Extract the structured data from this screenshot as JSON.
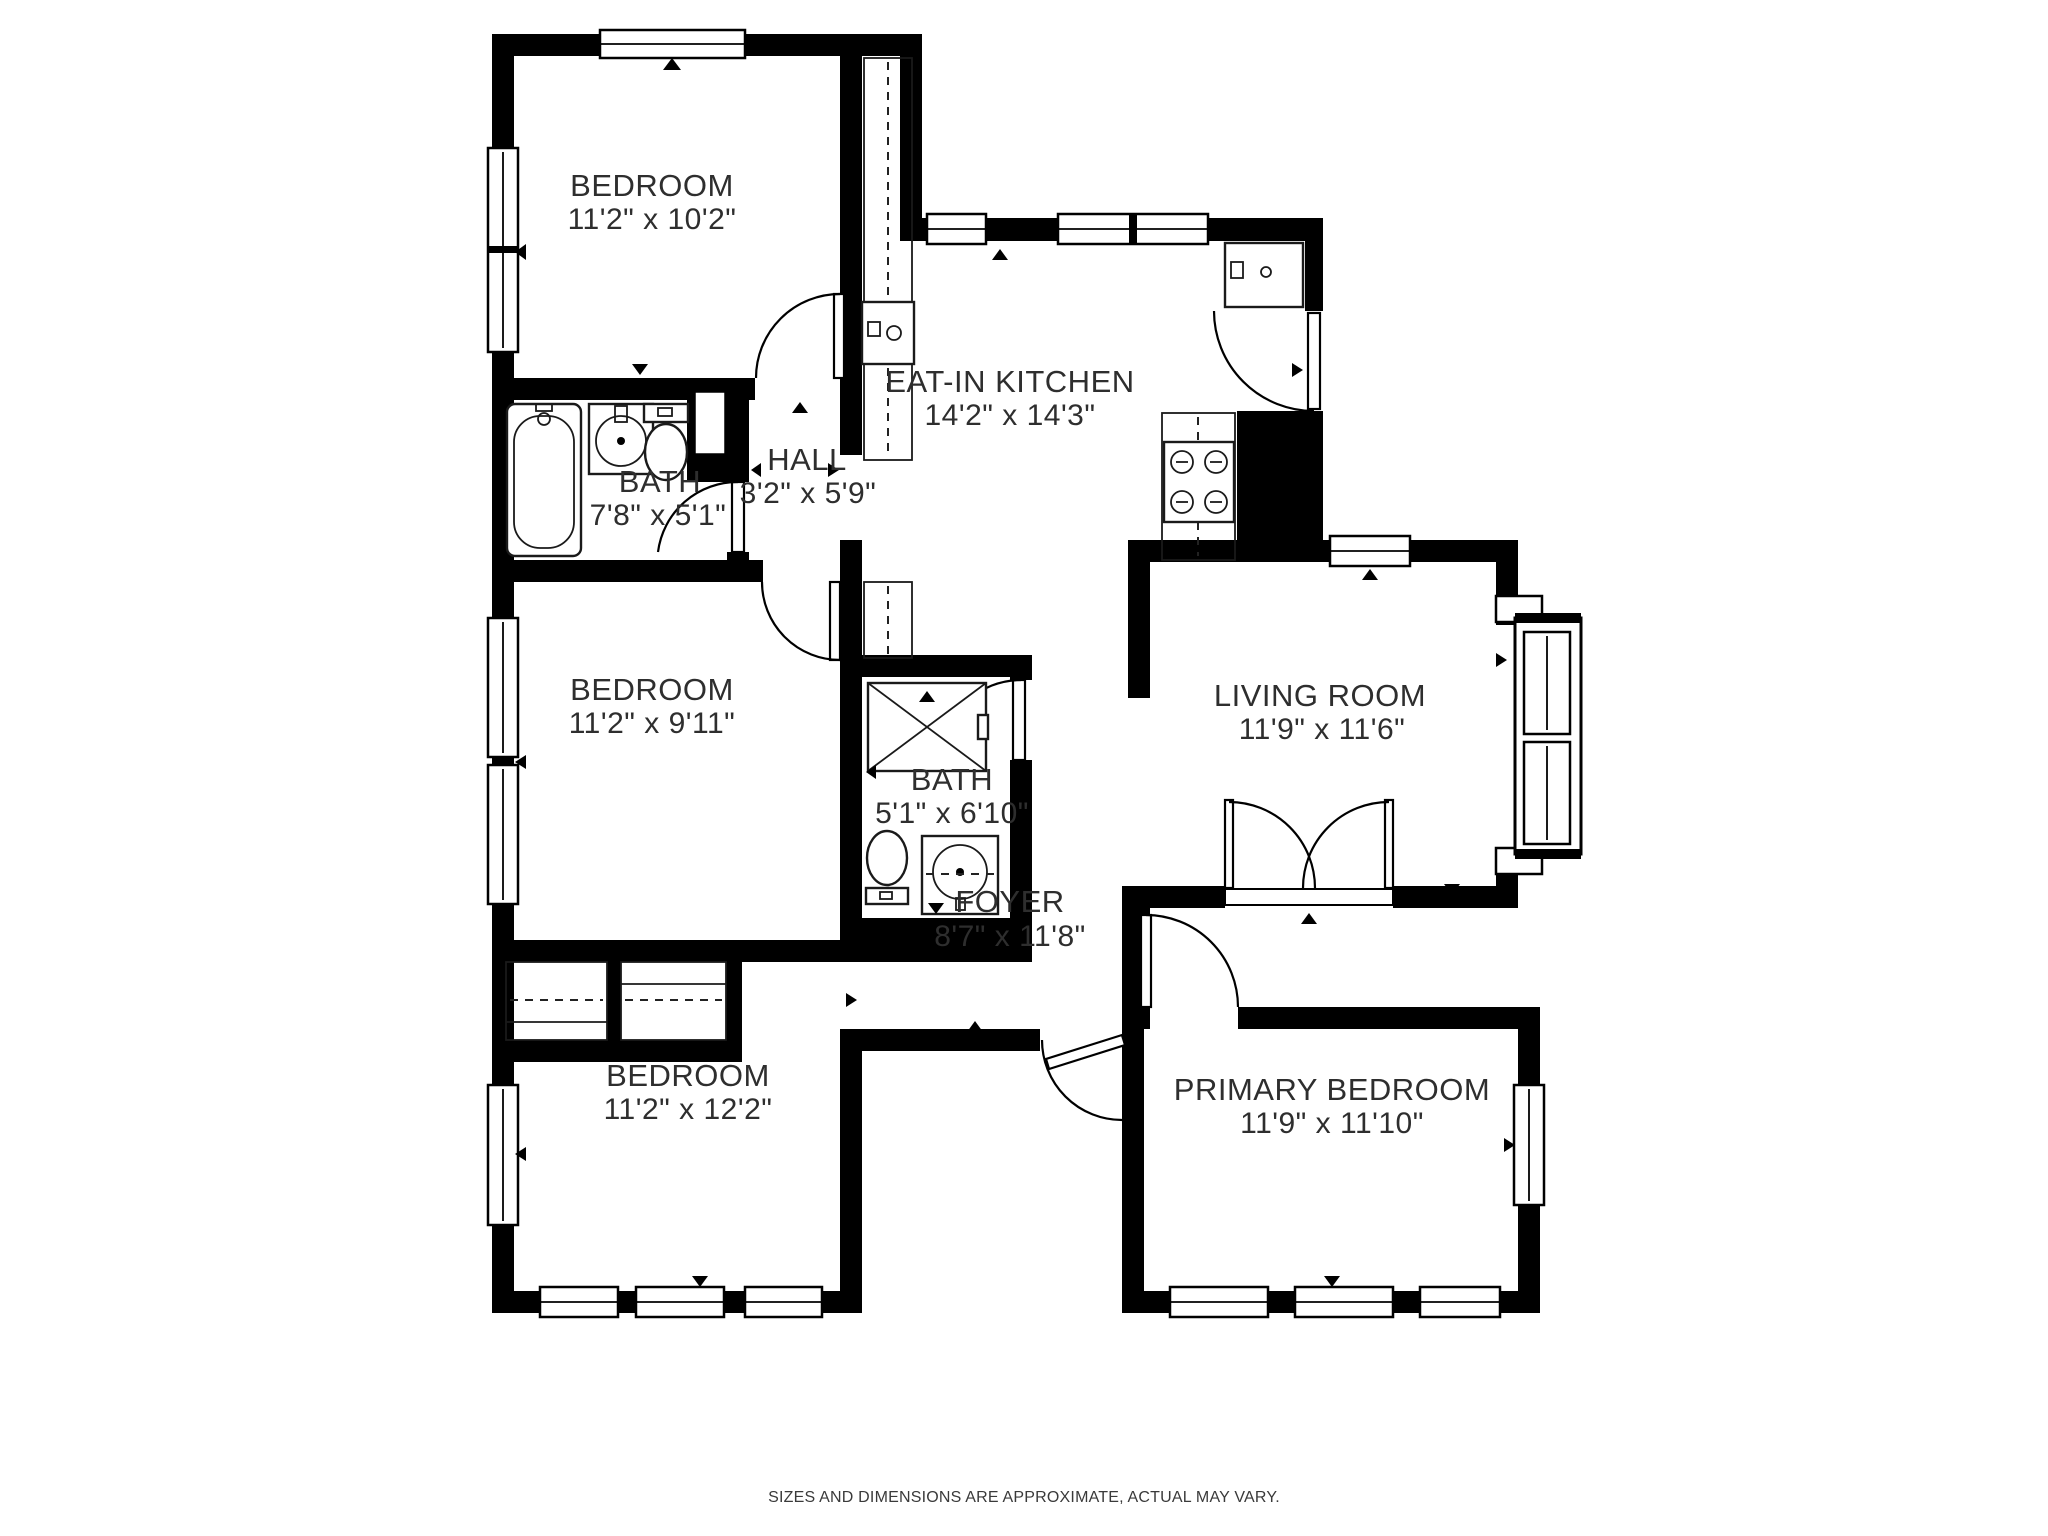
{
  "plan": {
    "title": "floor-plan",
    "rooms": [
      {
        "id": "bedroom-top-left",
        "name": "BEDROOM",
        "dims": "11'2\" x 10'2\""
      },
      {
        "id": "eat-in-kitchen",
        "name": "EAT-IN KITCHEN",
        "dims": "14'2\" x 14'3\""
      },
      {
        "id": "bath-top",
        "name": "BATH",
        "dims": "7'8\" x 5'1\""
      },
      {
        "id": "hall",
        "name": "HALL",
        "dims": "3'2\" x 5'9\""
      },
      {
        "id": "bedroom-middle",
        "name": "BEDROOM",
        "dims": "11'2\" x 9'11\""
      },
      {
        "id": "bath-middle",
        "name": "BATH",
        "dims": "5'1\" x 6'10\""
      },
      {
        "id": "living-room",
        "name": "LIVING ROOM",
        "dims": "11'9\" x 11'6\""
      },
      {
        "id": "foyer",
        "name": "FOYER",
        "dims": "8'7\" x 11'8\""
      },
      {
        "id": "bedroom-bottom-left",
        "name": "BEDROOM",
        "dims": "11'2\" x 12'2\""
      },
      {
        "id": "primary-bedroom",
        "name": "PRIMARY BEDROOM",
        "dims": "11'9\" x 11'10\""
      }
    ],
    "fixtures": [
      "bathtub",
      "vanity-sink",
      "toilet",
      "shower",
      "kitchen-sink",
      "range-burners",
      "refrigerator",
      "bay-window",
      "french-doors",
      "closet-shelves"
    ],
    "disclaimer": "SIZES AND DIMENSIONS ARE APPROXIMATE, ACTUAL MAY VARY.",
    "colors": {
      "wall": "#000000",
      "floor": "#ffffff",
      "text": "#2e2e2e"
    }
  }
}
